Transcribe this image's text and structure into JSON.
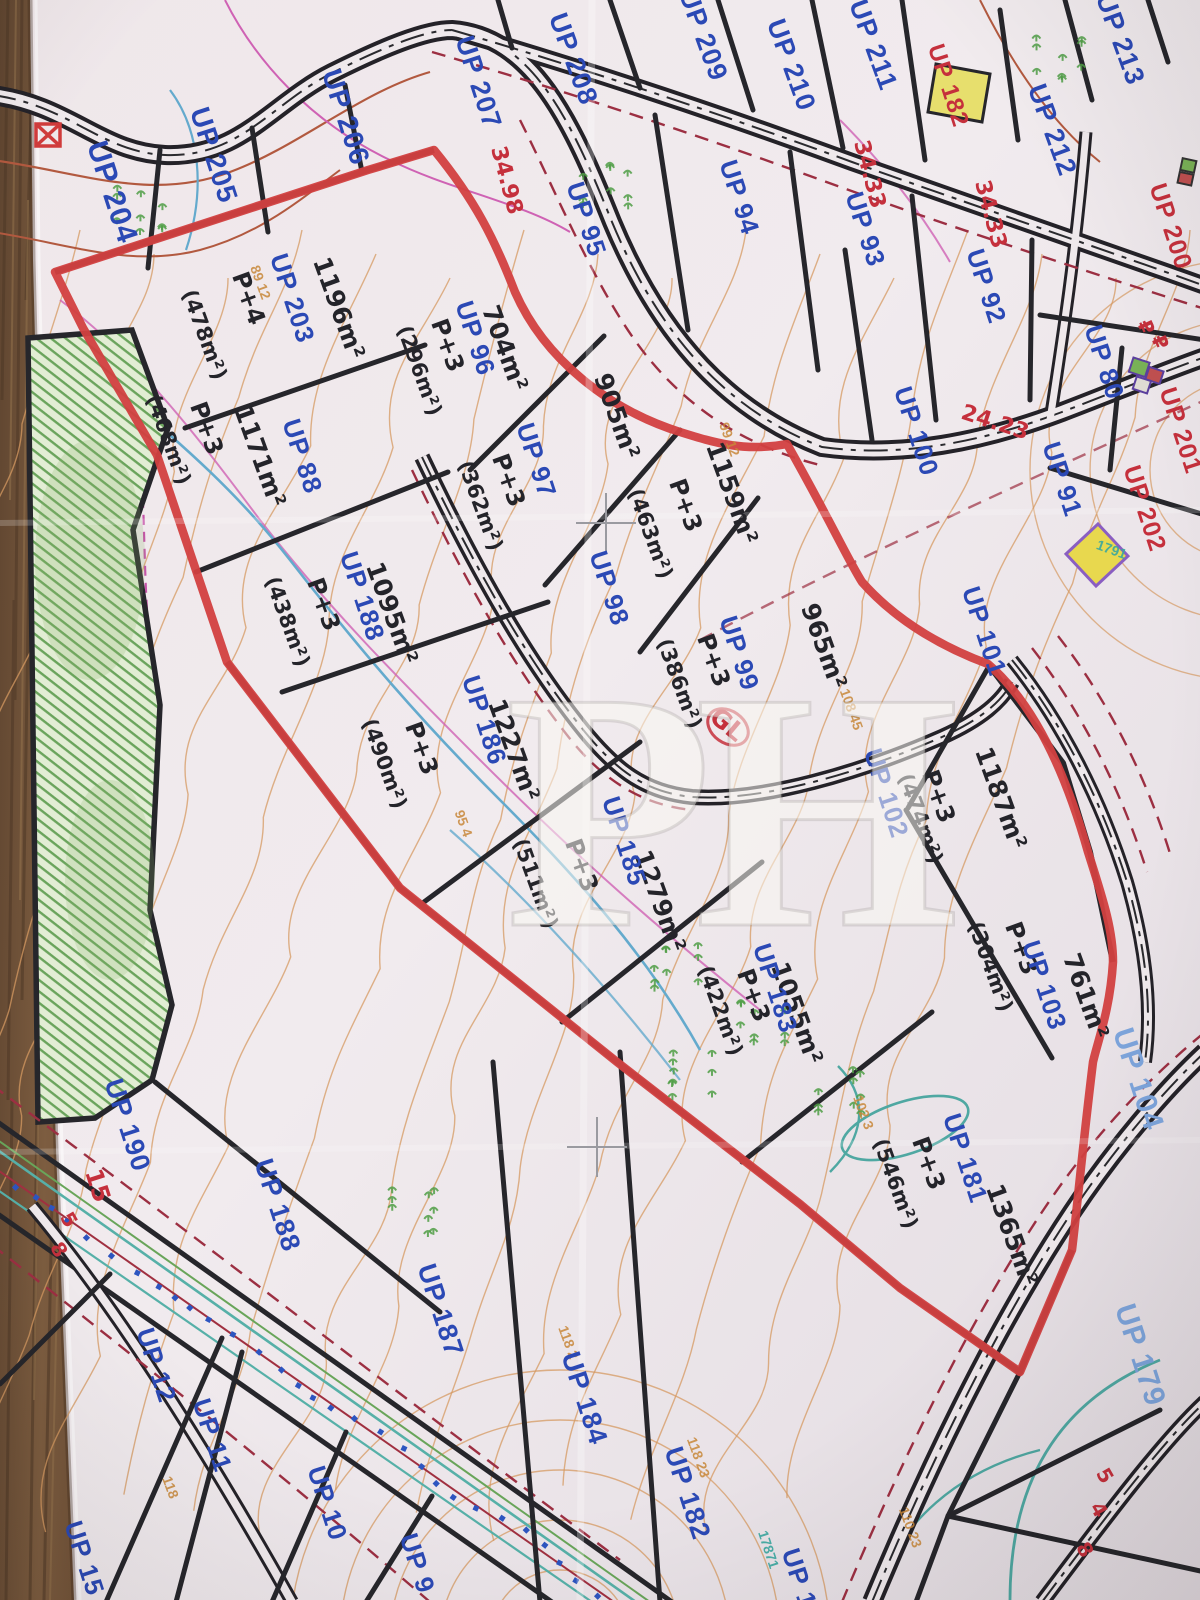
{
  "title": "Urban parcel plan photo (UP zones) on wooden table",
  "watermark": "PH",
  "colors": {
    "parcel_label_blue": "#2b49b5",
    "parcel_label_lightblue": "#7da4db",
    "annotation_red": "#c5303c",
    "zone_boundary_red": "#d24040",
    "boundary_black": "#2a282c",
    "contour_orange": "#d59a62",
    "stream_blue": "#64aacd",
    "hatch_green": "#63a058",
    "paper": "#efe9ec",
    "wood": "#7a5a3e"
  },
  "parcel_labels": [
    {
      "text": "UP 204",
      "x": 103,
      "y": 195,
      "rot": 72,
      "cls": "lbl-blue",
      "size": 30
    },
    {
      "text": "UP 205",
      "x": 205,
      "y": 158,
      "rot": 72,
      "cls": "lbl-blue",
      "size": 28
    },
    {
      "text": "UP 206",
      "x": 337,
      "y": 120,
      "rot": 72,
      "cls": "lbl-blue",
      "size": 28
    },
    {
      "text": "UP 207",
      "x": 470,
      "y": 85,
      "rot": 72,
      "cls": "lbl-blue",
      "size": 27
    },
    {
      "text": "UP 208",
      "x": 565,
      "y": 62,
      "rot": 70,
      "cls": "lbl-blue",
      "size": 27
    },
    {
      "text": "UP 209",
      "x": 695,
      "y": 38,
      "rot": 70,
      "cls": "lbl-blue",
      "size": 27
    },
    {
      "text": "UP 210",
      "x": 783,
      "y": 68,
      "rot": 70,
      "cls": "lbl-blue",
      "size": 27
    },
    {
      "text": "UP 211",
      "x": 865,
      "y": 48,
      "rot": 70,
      "cls": "lbl-blue",
      "size": 27
    },
    {
      "text": "UP 212",
      "x": 1044,
      "y": 133,
      "rot": 70,
      "cls": "lbl-blue",
      "size": 27
    },
    {
      "text": "UP 213",
      "x": 1112,
      "y": 42,
      "rot": 70,
      "cls": "lbl-blue",
      "size": 27
    },
    {
      "text": "UP 95",
      "x": 578,
      "y": 222,
      "rot": 72,
      "cls": "lbl-blue",
      "size": 26
    },
    {
      "text": "UP 94",
      "x": 731,
      "y": 200,
      "rot": 72,
      "cls": "lbl-blue",
      "size": 26
    },
    {
      "text": "UP 93",
      "x": 857,
      "y": 232,
      "rot": 72,
      "cls": "lbl-blue",
      "size": 26
    },
    {
      "text": "UP 92",
      "x": 978,
      "y": 289,
      "rot": 72,
      "cls": "lbl-blue",
      "size": 26
    },
    {
      "text": "UP 80",
      "x": 1096,
      "y": 365,
      "rot": 72,
      "cls": "lbl-blue",
      "size": 26
    },
    {
      "text": "UP 100",
      "x": 908,
      "y": 434,
      "rot": 72,
      "cls": "lbl-blue",
      "size": 26
    },
    {
      "text": "UP 91",
      "x": 1054,
      "y": 482,
      "rot": 72,
      "cls": "lbl-blue",
      "size": 26
    },
    {
      "text": "UP 101",
      "x": 976,
      "y": 634,
      "rot": 72,
      "cls": "lbl-blue",
      "size": 26
    },
    {
      "text": "UP 96",
      "x": 467,
      "y": 341,
      "rot": 72,
      "cls": "lbl-blue",
      "size": 26
    },
    {
      "text": "UP 97",
      "x": 528,
      "y": 463,
      "rot": 72,
      "cls": "lbl-blue",
      "size": 26
    },
    {
      "text": "UP 98",
      "x": 601,
      "y": 591,
      "rot": 72,
      "cls": "lbl-blue",
      "size": 26
    },
    {
      "text": "UP 99",
      "x": 731,
      "y": 656,
      "rot": 72,
      "cls": "lbl-blue",
      "size": 26
    },
    {
      "text": "UP 203",
      "x": 284,
      "y": 301,
      "rot": 72,
      "cls": "lbl-blue",
      "size": 26
    },
    {
      "text": "UP 88",
      "x": 294,
      "y": 459,
      "rot": 72,
      "cls": "lbl-blue",
      "size": 26
    },
    {
      "text": "UP 188",
      "x": 354,
      "y": 599,
      "rot": 72,
      "cls": "lbl-blue",
      "size": 26
    },
    {
      "text": "UP 186",
      "x": 476,
      "y": 723,
      "rot": 72,
      "cls": "lbl-blue",
      "size": 26
    },
    {
      "text": "UP 185",
      "x": 616,
      "y": 844,
      "rot": 72,
      "cls": "lbl-blue",
      "size": 26
    },
    {
      "text": "UP 183",
      "x": 767,
      "y": 991,
      "rot": 72,
      "cls": "lbl-blue",
      "size": 26
    },
    {
      "text": "UP 181",
      "x": 957,
      "y": 1161,
      "rot": 72,
      "cls": "lbl-blue",
      "size": 26
    },
    {
      "text": "UP 102",
      "x": 878,
      "y": 796,
      "rot": 72,
      "cls": "lbl-blue",
      "size": 26
    },
    {
      "text": "UP 103",
      "x": 1036,
      "y": 988,
      "rot": 72,
      "cls": "lbl-blue",
      "size": 26
    },
    {
      "text": "UP 104",
      "x": 1129,
      "y": 1082,
      "rot": 72,
      "cls": "lbl-lightblue",
      "size": 30
    },
    {
      "text": "UP 179",
      "x": 1131,
      "y": 1358,
      "rot": 72,
      "cls": "lbl-lightblue",
      "size": 30
    },
    {
      "text": "UP 190",
      "x": 119,
      "y": 1128,
      "rot": 72,
      "cls": "lbl-blue",
      "size": 27
    },
    {
      "text": "UP 188",
      "x": 269,
      "y": 1208,
      "rot": 72,
      "cls": "lbl-blue",
      "size": 27
    },
    {
      "text": "UP 187",
      "x": 432,
      "y": 1313,
      "rot": 72,
      "cls": "lbl-blue",
      "size": 27
    },
    {
      "text": "UP 184",
      "x": 576,
      "y": 1401,
      "rot": 72,
      "cls": "lbl-blue",
      "size": 27
    },
    {
      "text": "UP 182",
      "x": 679,
      "y": 1496,
      "rot": 72,
      "cls": "lbl-blue",
      "size": 27
    },
    {
      "text": "UP 12",
      "x": 148,
      "y": 1368,
      "rot": 72,
      "cls": "lbl-blue",
      "size": 26
    },
    {
      "text": "UP 11",
      "x": 204,
      "y": 1438,
      "rot": 72,
      "cls": "lbl-blue",
      "size": 26
    },
    {
      "text": "UP 10",
      "x": 319,
      "y": 1506,
      "rot": 72,
      "cls": "lbl-blue",
      "size": 26
    },
    {
      "text": "UP 15",
      "x": 76,
      "y": 1561,
      "rot": 72,
      "cls": "lbl-blue",
      "size": 26
    },
    {
      "text": "UP 9",
      "x": 409,
      "y": 1566,
      "rot": 72,
      "cls": "lbl-blue",
      "size": 26
    },
    {
      "text": "UP 1",
      "x": 791,
      "y": 1581,
      "rot": 72,
      "cls": "lbl-blue",
      "size": 26
    },
    {
      "text": "UP 182",
      "x": 941,
      "y": 88,
      "rot": 72,
      "cls": "lbl-red",
      "size": 24
    },
    {
      "text": "UP 200",
      "x": 1163,
      "y": 229,
      "rot": 72,
      "cls": "lbl-red",
      "size": 25
    },
    {
      "text": "UP 201",
      "x": 1173,
      "y": 433,
      "rot": 72,
      "cls": "lbl-red",
      "size": 25
    },
    {
      "text": "UP 202",
      "x": 1137,
      "y": 511,
      "rot": 72,
      "cls": "lbl-red",
      "size": 25
    }
  ],
  "area_labels": [
    {
      "text": "1196m²",
      "x": 331,
      "y": 311,
      "rot": 70,
      "size": 25
    },
    {
      "text": "P+4",
      "x": 241,
      "y": 301,
      "rot": 70,
      "size": 24
    },
    {
      "text": "(478m²)",
      "x": 198,
      "y": 337,
      "rot": 70,
      "size": 21
    },
    {
      "text": "P+3",
      "x": 199,
      "y": 431,
      "rot": 70,
      "size": 24
    },
    {
      "text": "(468m²)",
      "x": 162,
      "y": 442,
      "rot": 70,
      "size": 21
    },
    {
      "text": "1171m²",
      "x": 252,
      "y": 459,
      "rot": 70,
      "size": 25
    },
    {
      "text": "P+3",
      "x": 316,
      "y": 607,
      "rot": 70,
      "size": 24
    },
    {
      "text": "(438m²)",
      "x": 281,
      "y": 624,
      "rot": 70,
      "size": 21
    },
    {
      "text": "1095m²",
      "x": 384,
      "y": 616,
      "rot": 70,
      "size": 25
    },
    {
      "text": "704m²",
      "x": 497,
      "y": 351,
      "rot": 70,
      "size": 25
    },
    {
      "text": "P+3",
      "x": 440,
      "y": 348,
      "rot": 70,
      "size": 24
    },
    {
      "text": "(296m²)",
      "x": 413,
      "y": 373,
      "rot": 70,
      "size": 21
    },
    {
      "text": "905m²",
      "x": 609,
      "y": 419,
      "rot": 70,
      "size": 25
    },
    {
      "text": "P+3",
      "x": 501,
      "y": 483,
      "rot": 70,
      "size": 24
    },
    {
      "text": "(362m²)",
      "x": 474,
      "y": 508,
      "rot": 70,
      "size": 21
    },
    {
      "text": "1159m²",
      "x": 724,
      "y": 496,
      "rot": 70,
      "size": 25
    },
    {
      "text": "P+3",
      "x": 678,
      "y": 508,
      "rot": 70,
      "size": 24
    },
    {
      "text": "(463m²)",
      "x": 644,
      "y": 536,
      "rot": 70,
      "size": 21
    },
    {
      "text": "965m²",
      "x": 816,
      "y": 649,
      "rot": 70,
      "size": 25
    },
    {
      "text": "P+3",
      "x": 706,
      "y": 663,
      "rot": 70,
      "size": 24
    },
    {
      "text": "(386m²)",
      "x": 673,
      "y": 686,
      "rot": 70,
      "size": 21
    },
    {
      "text": "1227m²",
      "x": 506,
      "y": 753,
      "rot": 70,
      "size": 25
    },
    {
      "text": "P+3",
      "x": 414,
      "y": 751,
      "rot": 70,
      "size": 24
    },
    {
      "text": "(490m²)",
      "x": 378,
      "y": 766,
      "rot": 70,
      "size": 21
    },
    {
      "text": "1279m²",
      "x": 652,
      "y": 904,
      "rot": 70,
      "size": 25
    },
    {
      "text": "P+3",
      "x": 574,
      "y": 868,
      "rot": 70,
      "size": 24
    },
    {
      "text": "(511m²)",
      "x": 529,
      "y": 886,
      "rot": 70,
      "size": 21
    },
    {
      "text": "1055m²",
      "x": 789,
      "y": 1016,
      "rot": 70,
      "size": 25
    },
    {
      "text": "P+3",
      "x": 746,
      "y": 998,
      "rot": 70,
      "size": 24
    },
    {
      "text": "(422m²)",
      "x": 714,
      "y": 1013,
      "rot": 70,
      "size": 21
    },
    {
      "text": "1187m²",
      "x": 993,
      "y": 801,
      "rot": 70,
      "size": 25
    },
    {
      "text": "P+3",
      "x": 931,
      "y": 799,
      "rot": 70,
      "size": 24
    },
    {
      "text": "(474m²)",
      "x": 914,
      "y": 821,
      "rot": 70,
      "size": 21
    },
    {
      "text": "761m²",
      "x": 1078,
      "y": 999,
      "rot": 70,
      "size": 25
    },
    {
      "text": "P+3",
      "x": 1014,
      "y": 951,
      "rot": 70,
      "size": 24
    },
    {
      "text": "(304m²)",
      "x": 984,
      "y": 969,
      "rot": 70,
      "size": 21
    },
    {
      "text": "1365m²",
      "x": 1004,
      "y": 1238,
      "rot": 70,
      "size": 25
    },
    {
      "text": "P+3",
      "x": 921,
      "y": 1166,
      "rot": 70,
      "size": 24
    },
    {
      "text": "(546m²)",
      "x": 889,
      "y": 1186,
      "rot": 70,
      "size": 21
    }
  ],
  "red_marks": [
    {
      "text": "34.98",
      "x": 500,
      "y": 182,
      "rot": 75,
      "size": 22
    },
    {
      "text": "34.33",
      "x": 863,
      "y": 176,
      "rot": 75,
      "size": 22
    },
    {
      "text": "34.33",
      "x": 984,
      "y": 216,
      "rot": 75,
      "size": 22
    },
    {
      "text": "24.23",
      "x": 993,
      "y": 429,
      "rot": 18,
      "size": 22
    },
    {
      "text": "GL",
      "x": 722,
      "y": 731,
      "rot": 40,
      "size": 25
    },
    {
      "text": "15",
      "x": 90,
      "y": 1188,
      "rot": 72,
      "size": 24
    },
    {
      "text": "5",
      "x": 63,
      "y": 1223,
      "rot": 60,
      "size": 20
    },
    {
      "text": "8",
      "x": 53,
      "y": 1253,
      "rot": 60,
      "size": 20
    },
    {
      "text": "5",
      "x": 1099,
      "y": 1479,
      "rot": 60,
      "size": 20
    },
    {
      "text": "4",
      "x": 1093,
      "y": 1513,
      "rot": 60,
      "size": 20
    },
    {
      "text": "8",
      "x": 1079,
      "y": 1553,
      "rot": 60,
      "size": 20
    },
    {
      "text": "₽",
      "x": 1140,
      "y": 330,
      "rot": 65,
      "size": 20
    },
    {
      "text": "₽",
      "x": 1154,
      "y": 345,
      "rot": 65,
      "size": 20
    }
  ],
  "elevation_labels": [
    {
      "text": "108 45",
      "x": 847,
      "y": 711,
      "rot": 70
    },
    {
      "text": "99 12",
      "x": 725,
      "y": 441,
      "rot": 70
    },
    {
      "text": "89 12",
      "x": 256,
      "y": 284,
      "rot": 70
    },
    {
      "text": "95 4",
      "x": 459,
      "y": 825,
      "rot": 70
    },
    {
      "text": "102 3",
      "x": 859,
      "y": 1114,
      "rot": 70
    },
    {
      "text": "118 2",
      "x": 564,
      "y": 1344,
      "rot": 70
    },
    {
      "text": "118 23",
      "x": 694,
      "y": 1459,
      "rot": 70
    },
    {
      "text": "110 23",
      "x": 906,
      "y": 1529,
      "rot": 70
    },
    {
      "text": "118",
      "x": 166,
      "y": 1489,
      "rot": 70
    }
  ],
  "teal_labels": [
    {
      "text": "17871",
      "x": 764,
      "y": 1551,
      "rot": 72
    },
    {
      "text": "1791",
      "x": 1110,
      "y": 554,
      "rot": 20
    }
  ]
}
